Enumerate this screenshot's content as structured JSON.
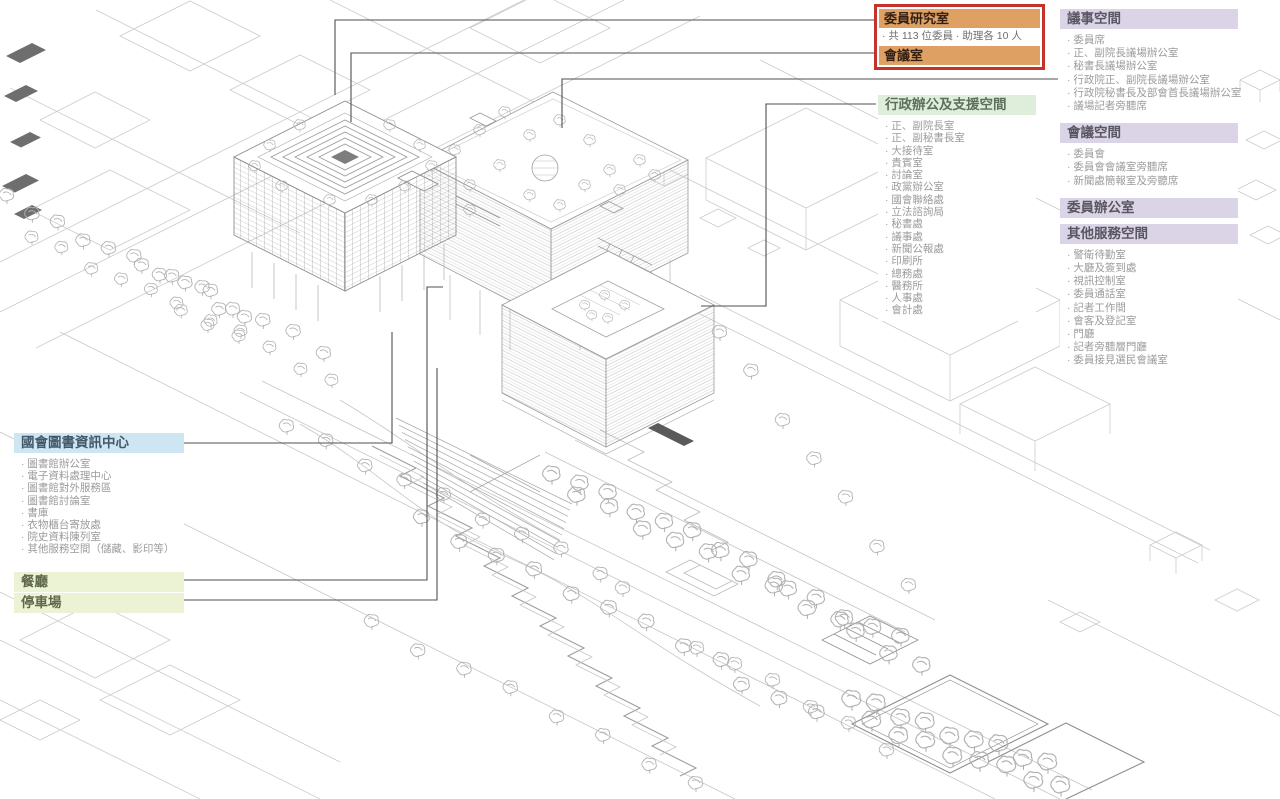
{
  "callout": {
    "rows": [
      {
        "type": "bar",
        "text": "委員研究室"
      },
      {
        "type": "note",
        "text": "· 共 113 位委員 · 助理各 10 人"
      },
      {
        "type": "bar",
        "text": "會議室"
      }
    ]
  },
  "legend": {
    "groups": [
      {
        "id": "assembly",
        "title": "議事空間",
        "color": "#dad4e6",
        "items": [
          "委員席",
          "正、副院長議場辦公室",
          "秘書長議場辦公室",
          "行政院正、副院長議場辦公室",
          "行政院秘書長及部會首長議場辦公室",
          "議場記者旁聽席"
        ]
      },
      {
        "id": "meeting",
        "title": "會議空間",
        "color": "#dad4e6",
        "items": [
          "委員會",
          "委員會會議室旁聽席",
          "新聞處簡報室及旁聽席"
        ]
      },
      {
        "id": "member-office",
        "title": "委員辦公室",
        "color": "#dad4e6",
        "items": []
      },
      {
        "id": "other-service",
        "title": "其他服務空間",
        "color": "#dad4e6",
        "items": [
          "警衛待勤室",
          "大廳及簽到處",
          "視訊控制室",
          "委員通話室",
          "記者工作間",
          "會客及登記室",
          "門廳",
          "記者旁聽層門廳",
          "委員接見選民會議室"
        ]
      },
      {
        "id": "admin",
        "title": "行政辦公及支援空間",
        "color": "#deeeda",
        "items": [
          "正、副院長室",
          "正、副秘書長室",
          "大接待室",
          "貴賓室",
          "討論室",
          "政黨辦公室",
          "國會聯絡處",
          "立法諮詢局",
          "秘書處",
          "議事處",
          "新聞公報處",
          "印刷所",
          "總務處",
          "醫務所",
          "人事處",
          "會計處"
        ]
      },
      {
        "id": "library",
        "title": "國會圖書資訊中心",
        "color": "#cee5f2",
        "items": [
          "圖書館辦公室",
          "電子資料處理中心",
          "圖書館對外服務區",
          "圖書館討論室",
          "書庫",
          "衣物櫃台寄放處",
          "院史資料陳列室",
          "其他服務空間（儲藏、影印等）"
        ]
      },
      {
        "id": "restaurant",
        "title": "餐廳",
        "color": "#ecf2d4",
        "items": []
      },
      {
        "id": "parking",
        "title": "停車場",
        "color": "#ecf2d4",
        "items": []
      }
    ]
  },
  "colors": {
    "highlight_box_border": "#c5322b",
    "highlight_bar": "#dfa063",
    "purple_header": "#dad4e6",
    "green_header": "#deeeda",
    "blue_header": "#cee5f2",
    "lime_header": "#ecf2d4",
    "leader_line": "#4f4f4f"
  }
}
